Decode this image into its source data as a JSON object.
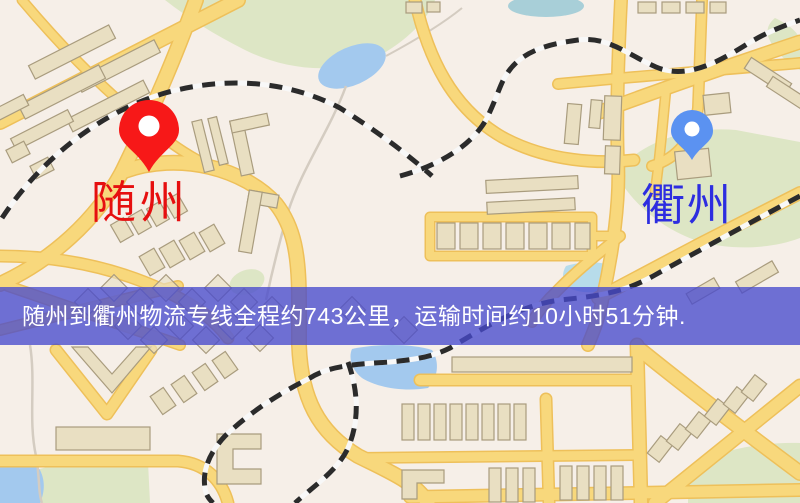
{
  "map": {
    "origin": {
      "label": "随州",
      "label_color": "#e60f0f",
      "pin_color": "#f71818",
      "pin_hole_color": "#ffffff"
    },
    "destination": {
      "label": "衢州",
      "label_color": "#2d2de0",
      "pin_color": "#5b92f1",
      "pin_hole_color": "#ffffff"
    },
    "style_colors": {
      "background": "#f6efe8",
      "park": "#dde6c5",
      "water": "#a3c9ee",
      "road": "#f8d87c",
      "road_casing": "#eec05a",
      "railway": "#2b2b2b",
      "building": "#e9dfc2"
    }
  },
  "banner": {
    "text": "随州到衢州物流专线全程约743公里，运输时间约10小时51分钟.",
    "distance_km": "743",
    "duration": "10小时51分钟",
    "background_color": "#484acd",
    "text_color": "#ffffff"
  }
}
